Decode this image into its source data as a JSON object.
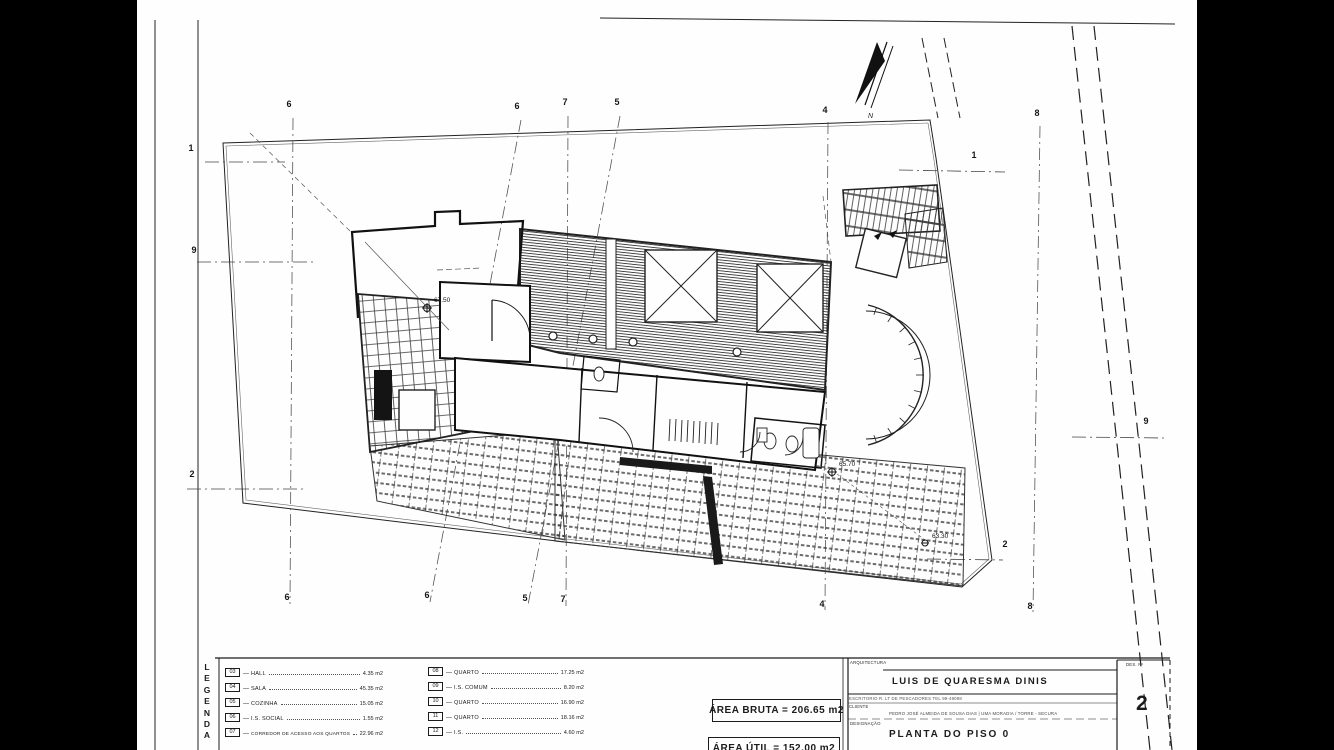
{
  "page": {
    "paper_color": "#fefefe",
    "ink_color": "#1c1c1c",
    "background": "#000000"
  },
  "title_block": {
    "discipline_label": "ARQUITECTURA",
    "architect_name": "LUIS DE QUARESMA DINIS",
    "office_line": "ESCRITORIO  R. LT DE PESCADORES  TEL 99-49098",
    "client_label": "CLIENTE",
    "client_line": "PEDRO JOSÉ ALMEIDA DE SOUSA DIAS | UMA MORADIA / TORRE - SECURA",
    "drawing_label": "DESIGNAÇÃO",
    "drawing_title": "PLANTA DO PISO 0",
    "sheet_label": "DES. Nº",
    "sheet_number": "2"
  },
  "areas": {
    "bruta": "ÁREA BRUTA = 206.65 m2",
    "util": "ÁREA ÚTIL = 152.00 m2"
  },
  "legend": {
    "separator": "—",
    "title_letters": [
      "L",
      "E",
      "G",
      "E",
      "N",
      "D",
      "A"
    ],
    "column1": [
      {
        "id": "03",
        "label": "HALL",
        "area": "4.35 m2"
      },
      {
        "id": "04",
        "label": "SALA",
        "area": "45.35 m2"
      },
      {
        "id": "05",
        "label": "COZINHA",
        "area": "15.05 m2"
      },
      {
        "id": "06",
        "label": "I.S. SOCIAL",
        "area": "1.55 m2"
      },
      {
        "id": "07",
        "label": "CORREDOR DE ACESSO AOS QUARTOS",
        "area": "22.96 m2"
      }
    ],
    "column2": [
      {
        "id": "08",
        "label": "QUARTO",
        "area": "17.25 m2"
      },
      {
        "id": "09",
        "label": "I.S. COMUM",
        "area": "8.20 m2"
      },
      {
        "id": "10",
        "label": "QUARTO",
        "area": "16.90 m2"
      },
      {
        "id": "11",
        "label": "QUARTO",
        "area": "18.16 m2"
      },
      {
        "id": "12",
        "label": "I.S.",
        "area": "4.60 m2"
      }
    ]
  },
  "plan": {
    "north_label": "N",
    "levels": [
      {
        "text": "67.50",
        "x": 297,
        "y": 301
      },
      {
        "text": "65.70",
        "x": 702,
        "y": 465
      },
      {
        "text": "63.30",
        "x": 795,
        "y": 537
      }
    ],
    "grid_markers": [
      {
        "label": "6",
        "x": 152,
        "y": 104
      },
      {
        "label": "6",
        "x": 380,
        "y": 106
      },
      {
        "label": "7",
        "x": 428,
        "y": 102
      },
      {
        "label": "5",
        "x": 480,
        "y": 102
      },
      {
        "label": "4",
        "x": 688,
        "y": 110
      },
      {
        "label": "8",
        "x": 900,
        "y": 113
      },
      {
        "label": "6",
        "x": 150,
        "y": 597
      },
      {
        "label": "6",
        "x": 290,
        "y": 595
      },
      {
        "label": "5",
        "x": 388,
        "y": 598
      },
      {
        "label": "7",
        "x": 426,
        "y": 599
      },
      {
        "label": "4",
        "x": 685,
        "y": 604
      },
      {
        "label": "8",
        "x": 893,
        "y": 606
      },
      {
        "label": "2",
        "x": 868,
        "y": 544
      },
      {
        "label": "1",
        "x": 54,
        "y": 148
      },
      {
        "label": "9",
        "x": 57,
        "y": 250
      },
      {
        "label": "2",
        "x": 55,
        "y": 474
      },
      {
        "label": "1",
        "x": 837,
        "y": 155
      },
      {
        "label": "9",
        "x": 1009,
        "y": 421
      }
    ]
  }
}
